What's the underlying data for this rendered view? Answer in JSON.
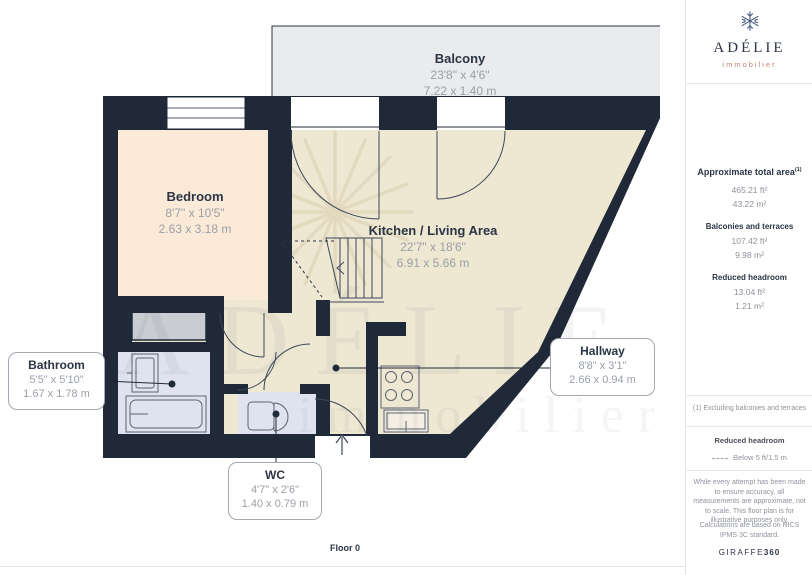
{
  "brand": {
    "name": "ADÉLIE",
    "tagline": "immobilier",
    "footer_name": "GIRAFFE",
    "footer_suffix": "360"
  },
  "sidebar": {
    "summary": {
      "title": "Approximate total area",
      "title_sup": "(1)",
      "total_ft": "465.21 ft²",
      "total_m": "43.22 m²",
      "balconies_label": "Balconies and terraces",
      "balconies_ft": "107.42 ft²",
      "balconies_m": "9.98 m²",
      "reduced_label": "Reduced headroom",
      "reduced_ft": "13.04 ft²",
      "reduced_m": "1.21 m²"
    },
    "footnote": "(1) Excluding balconies and terraces",
    "legend_title": "Reduced headroom",
    "legend_item": "Below 5 ft/1.5 m",
    "disclaimer": "While every attempt has been made to ensure accuracy, all measurements are approximate, not to scale. This floor plan is for illustrative purposes only.",
    "standard_note": "Calculations are based on RICS IPMS 3C standard."
  },
  "floorplan": {
    "floor_label": "Floor 0",
    "watermark_line1": "ADÉLIE",
    "watermark_line2": "immobilier",
    "rooms": [
      {
        "id": "balcony",
        "name": "Balcony",
        "dims_ft": "23'8\" x 4'6\"",
        "dims_m": "7.22 x 1.40 m"
      },
      {
        "id": "bedroom",
        "name": "Bedroom",
        "dims_ft": "8'7\" x 10'5\"",
        "dims_m": "2.63 x 3.18 m"
      },
      {
        "id": "kitchen",
        "name": "Kitchen / Living Area",
        "dims_ft": "22'7\" x 18'6\"",
        "dims_m": "6.91 x 5.66 m"
      },
      {
        "id": "bathroom",
        "name": "Bathroom",
        "dims_ft": "5'5\" x 5'10\"",
        "dims_m": "1.67 x 1.78 m"
      },
      {
        "id": "wc",
        "name": "WC",
        "dims_ft": "4'7\" x 2'6\"",
        "dims_m": "1.40 x 0.79 m"
      },
      {
        "id": "hallway",
        "name": "Hallway",
        "dims_ft": "8'8\" x 3'1\"",
        "dims_m": "2.66 x 0.94 m"
      }
    ],
    "colors": {
      "wall": "#1f2937",
      "bedroom_fill": "#fcead8",
      "living_fill": "#eee7d2",
      "wet_room_fill": "#dfe3f0",
      "balcony_fill": "#e9ebec",
      "closet_fill": "#c9ccd1",
      "brand_accent": "#c5806e",
      "label_text": "#2b3545",
      "dim_text": "#9aa0a8"
    }
  }
}
